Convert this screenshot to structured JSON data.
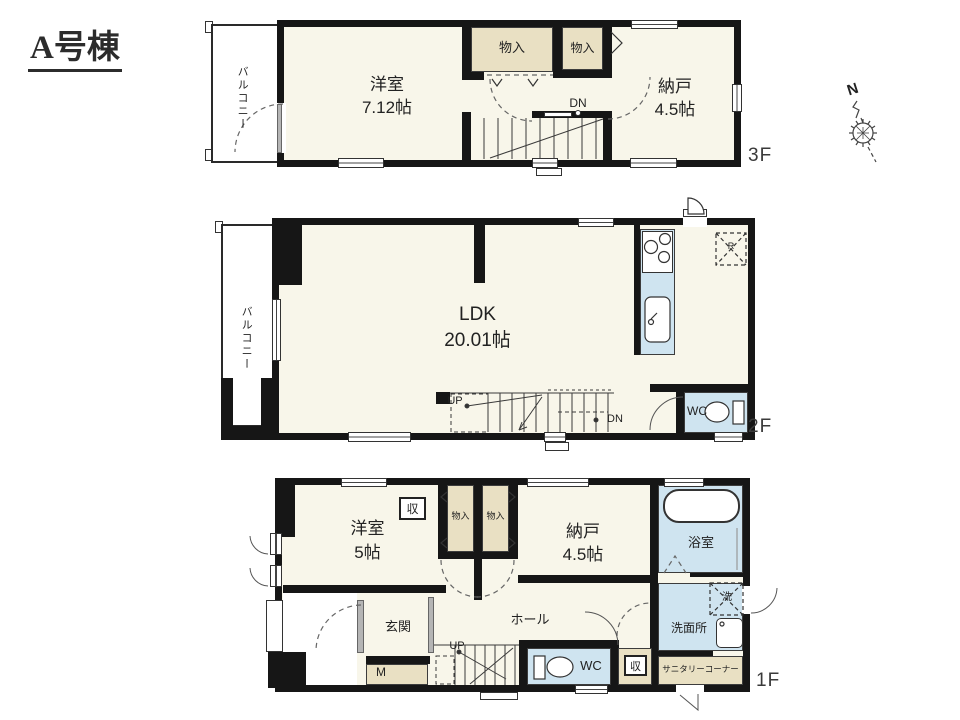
{
  "title": "A号棟",
  "compass": {
    "north": "N"
  },
  "floors": {
    "f3": {
      "floor_label": "3F",
      "balcony": "バルコニー",
      "room1": "洋室",
      "room1_size": "7.12帖",
      "closet1": "物入",
      "closet2": "物入",
      "room2": "納戸",
      "room2_size": "4.5帖",
      "stairs_dn": "DN"
    },
    "f2": {
      "floor_label": "2F",
      "balcony": "バルコニー",
      "ldk": "LDK",
      "ldk_size": "20.01帖",
      "stairs_up": "UP",
      "stairs_dn": "DN",
      "wc": "WC",
      "fridge": "R"
    },
    "f1": {
      "floor_label": "1F",
      "room1": "洋室",
      "room1_size": "5帖",
      "storage1": "収",
      "closet1": "物入",
      "closet2": "物入",
      "room2": "納戸",
      "room2_size": "4.5帖",
      "bath": "浴室",
      "laundry": "洗",
      "washroom": "洗面所",
      "wc": "WC",
      "storage2": "収",
      "sanitary": "サニタリーコーナー",
      "hall": "ホール",
      "entrance": "玄関",
      "meter": "M",
      "stairs_up": "UP"
    }
  },
  "colors": {
    "wall": "#161616",
    "room_fill": "#f8f6ea",
    "closet_fill": "#e9e0c3",
    "fixture_fill": "#cfe4f0",
    "background": "#ffffff"
  }
}
